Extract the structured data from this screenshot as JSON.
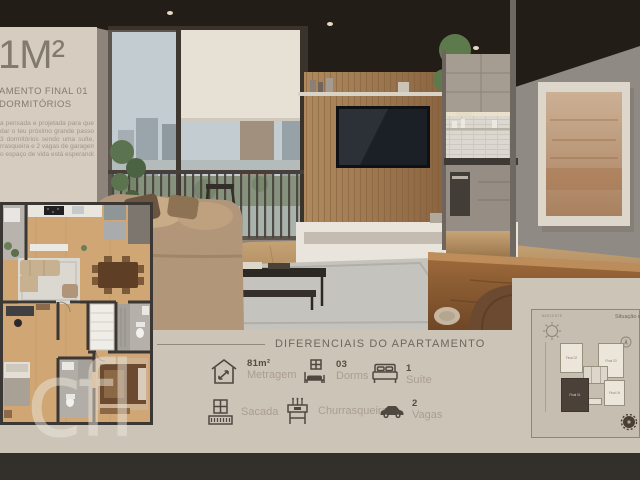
{
  "colors": {
    "panel_beige": "#d6ccc0",
    "bottom_beige": "#cdc4b8",
    "dark_strip": "#33302c",
    "heading_text": "#6f675c",
    "icon_brown": "#4f4840",
    "highlight_unit": "#4c4138"
  },
  "title_block": {
    "headline": "1M²",
    "subtitle_line1": "AMENTO FINAL 01",
    "subtitle_line2": "DORMITÓRIOS",
    "paragraph_lines": [
      "a pensada e projetada para que",
      "dar o teu próximo grande passo",
      "3 dormitórios sendo uma suíte,",
      "rrasqueira e 2 vagas de garagem",
      "o espaço de vida está esperando"
    ]
  },
  "features_section": {
    "heading": "DIFERENCIAIS DO APARTAMENTO",
    "features": [
      {
        "icon": "area-measure-icon",
        "value": "81m²",
        "label": "Metragem"
      },
      {
        "icon": "bunk-bed-icon",
        "value": "03",
        "label": "Dorms"
      },
      {
        "icon": "double-bed-icon",
        "value": "1",
        "label": "Suíte"
      },
      {
        "icon": "balcony-icon",
        "value": "",
        "label": "Sacada"
      },
      {
        "icon": "grill-icon",
        "value": "",
        "label": "Churrasqueira"
      },
      {
        "icon": "car-icon",
        "value": "2",
        "label": "Vagas"
      }
    ]
  },
  "site_plan": {
    "caption": "Situação e posição",
    "sun_label": "NASCENTE",
    "units": [
      {
        "label": "Final 02",
        "highlighted": false
      },
      {
        "label": "Final 03",
        "highlighted": false
      },
      {
        "label": "Final 01",
        "highlighted": true
      },
      {
        "label": "Final 04",
        "highlighted": false
      }
    ]
  },
  "watermark_text": "cfl"
}
